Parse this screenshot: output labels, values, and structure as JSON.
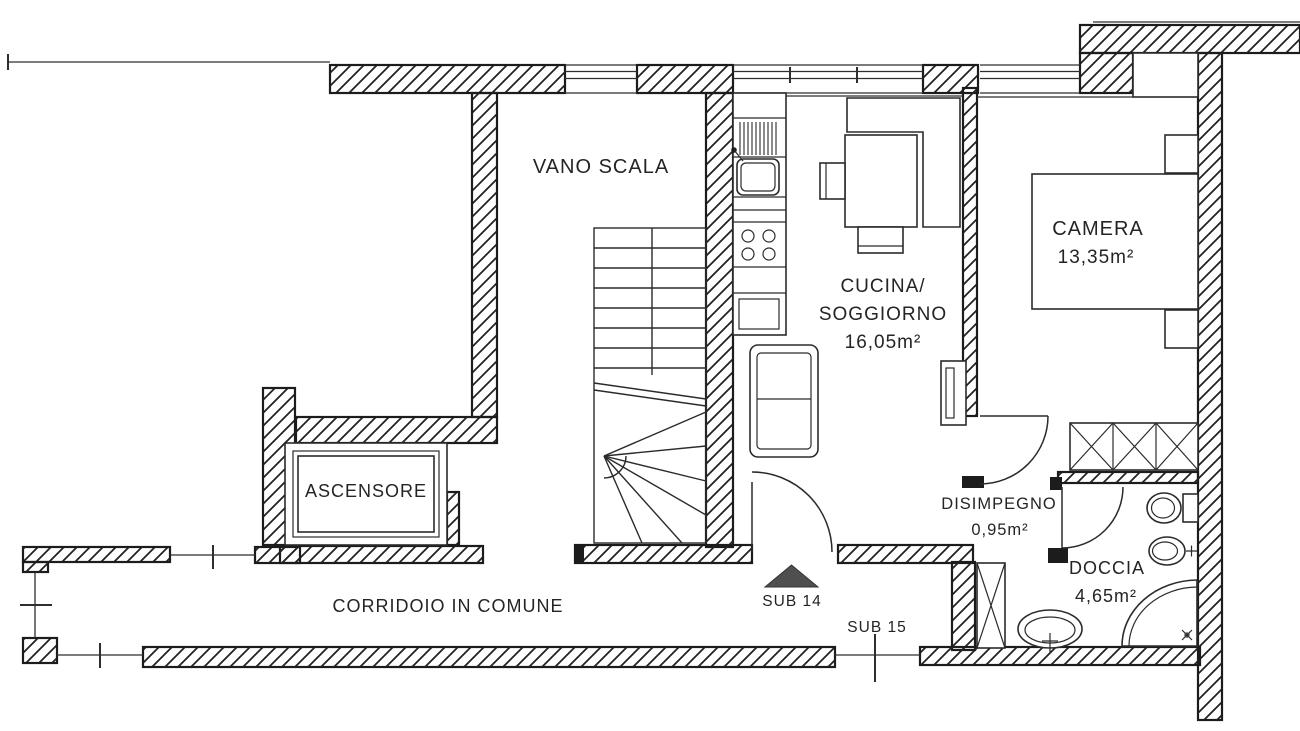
{
  "drawing": {
    "type": "floor-plan",
    "language": "it",
    "rooms": [
      {
        "id": "vano-scala",
        "label": "VANO SCALA"
      },
      {
        "id": "cucina-soggiorno",
        "label_line1": "CUCINA/",
        "label_line2": "SOGGIORNO",
        "area": "16,05m²"
      },
      {
        "id": "camera",
        "label": "CAMERA",
        "area": "13,35m²"
      },
      {
        "id": "ascensore",
        "label": "ASCENSORE"
      },
      {
        "id": "corridoio",
        "label": "CORRIDOIO IN COMUNE"
      },
      {
        "id": "disimpegno",
        "label": "DISIMPEGNO",
        "area": "0,95m²"
      },
      {
        "id": "doccia",
        "label": "DOCCIA",
        "area": "4,65m²"
      }
    ],
    "units": [
      {
        "id": "sub-14",
        "label": "SUB 14"
      },
      {
        "id": "sub-15",
        "label": "SUB 15"
      }
    ],
    "colors": {
      "ink": "#1c1c1c",
      "paper": "#ffffff",
      "entrance_marker": "#4f4f4f"
    }
  }
}
